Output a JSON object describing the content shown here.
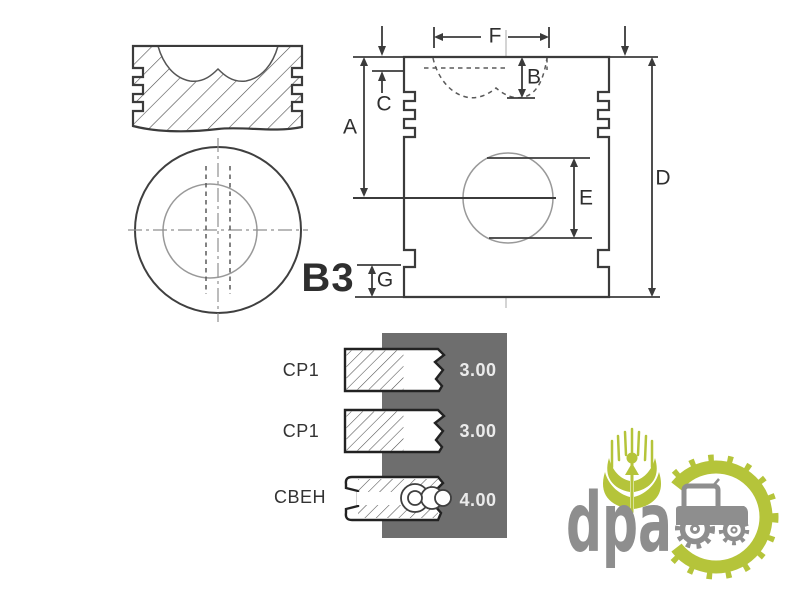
{
  "colors": {
    "background": "#ffffff",
    "line": "#3b3b3b",
    "line-strong": "#222222",
    "line-light": "#999999",
    "centerline": "#b8b8b8",
    "panel": "#6e6e6e",
    "panel-text": "#ebebeb",
    "label-text": "#2e2e2e",
    "logo-green": "#b5c43a",
    "logo-gray": "#8e8e8e"
  },
  "diagram": {
    "part_label": "B3",
    "dimensions": {
      "a": "A",
      "b": "B",
      "c": "C",
      "d": "D",
      "e": "E",
      "f": "F",
      "g": "G"
    }
  },
  "ring_panel": {
    "rows": [
      {
        "label": "CP1",
        "value": "3.00",
        "icon": "compression-ring-cross-section"
      },
      {
        "label": "CP1",
        "value": "3.00",
        "icon": "compression-ring-cross-section"
      },
      {
        "label": "CBEH",
        "value": "4.00",
        "icon": "oil-control-ring-cross-section"
      }
    ]
  },
  "logo": {
    "text": "dpa"
  }
}
